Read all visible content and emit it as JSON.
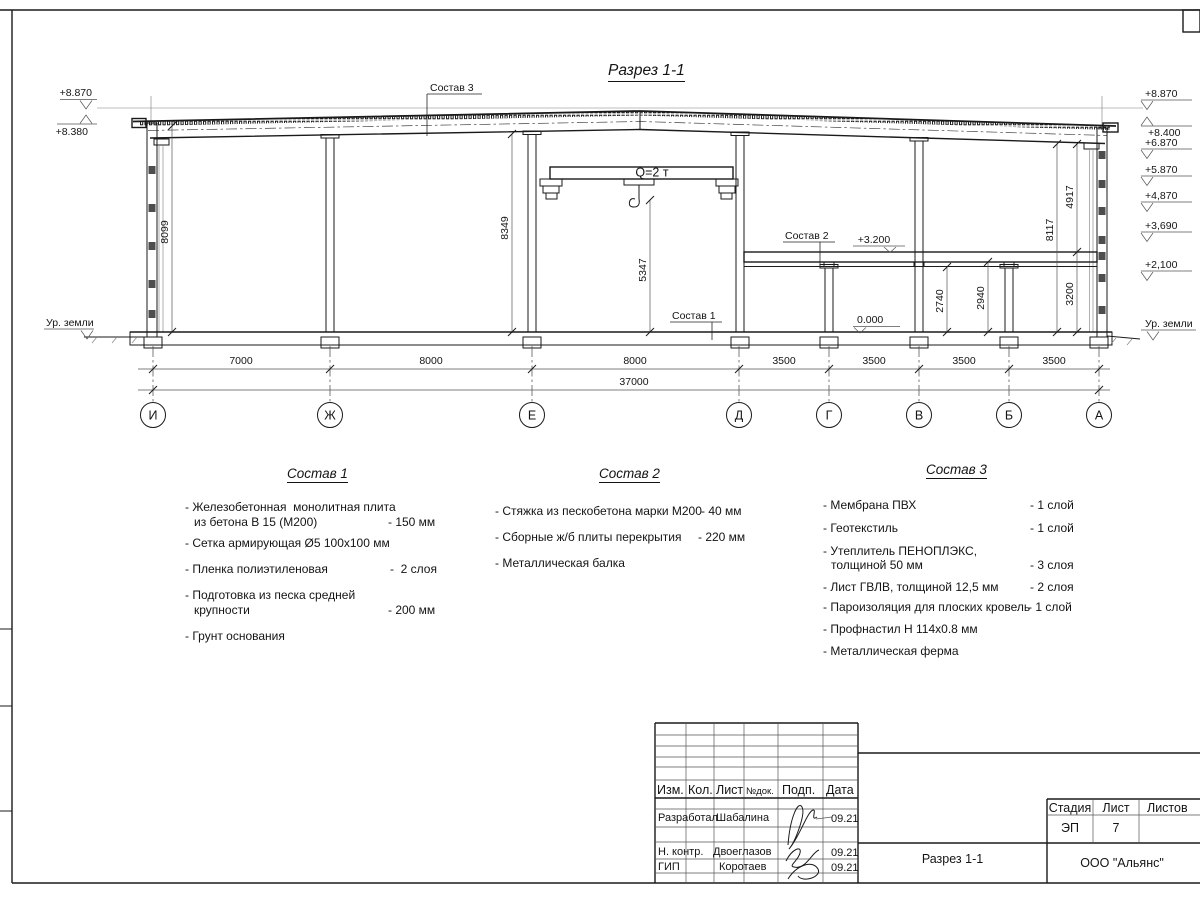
{
  "drawing": {
    "title": "Разрез 1-1",
    "crane_label": "Q=2 т",
    "leaders": {
      "s1": "Состав 1",
      "s2": "Состав 2",
      "s3": "Состав 3"
    },
    "elev_left": {
      "top": "+8.870",
      "eave": "+8.380",
      "ground": "Ур. земли"
    },
    "elev_right": [
      "+8.870",
      "+8.400",
      "+6.870",
      "+5.870",
      "+4,870",
      "+3,690",
      "+2,100"
    ],
    "elev_right_ground": "Ур. земли",
    "marks": {
      "mezz": "+3.200",
      "zero": "0.000"
    },
    "vdims": {
      "wall_left": "8099",
      "hall": "8349",
      "crane": "5347",
      "full_right": "8117",
      "upper_right": "4917",
      "mezz_h": "3200",
      "slab": "2940",
      "beam": "2740"
    },
    "hdims": [
      "7000",
      "8000",
      "8000",
      "3500",
      "3500",
      "3500",
      "3500"
    ],
    "total": "37000",
    "axes": [
      "И",
      "Ж",
      "Е",
      "Д",
      "Г",
      "В",
      "Б",
      "А"
    ]
  },
  "sostav1": {
    "title": "Состав 1",
    "items": [
      {
        "line1": "- Железобетонная  монолитная плита",
        "line2": "из бетона В 15 (М200)",
        "value": "- 150 мм"
      },
      {
        "line1": "- Сетка армирующая Ø5 100х100 мм",
        "line2": "",
        "value": ""
      },
      {
        "line1": "- Пленка полиэтиленовая",
        "line2": "",
        "value": "-  2 слоя"
      },
      {
        "line1": "- Подготовка из песка средней",
        "line2": "крупности",
        "value": "- 200 мм"
      },
      {
        "line1": "- Грунт основания",
        "line2": "",
        "value": ""
      }
    ]
  },
  "sostav2": {
    "title": "Состав 2",
    "items": [
      {
        "line1": "- Стяжка из пескобетона марки М200",
        "line2": "",
        "value": "- 40 мм"
      },
      {
        "line1": "- Сборные ж/б плиты перекрытия",
        "line2": "",
        "value": "- 220 мм"
      },
      {
        "line1": "- Металлическая балка",
        "line2": "",
        "value": ""
      }
    ]
  },
  "sostav3": {
    "title": "Состав 3",
    "items": [
      {
        "line1": "- Мембрана ПВХ",
        "line2": "",
        "value": "- 1 слой"
      },
      {
        "line1": "- Геотекстиль",
        "line2": "",
        "value": "- 1 слой"
      },
      {
        "line1": "- Утеплитель ПЕНОПЛЭКС,",
        "line2": "толщиной 50 мм",
        "value": "- 3 слоя"
      },
      {
        "line1": "- Лист ГВЛВ, толщиной 12,5 мм",
        "line2": "",
        "value": "- 2 слоя"
      },
      {
        "line1": "- Пароизоляция для плоских кровель",
        "line2": "",
        "value": "- 1 слой"
      },
      {
        "line1": "- Профнастил Н 114х0.8 мм",
        "line2": "",
        "value": ""
      },
      {
        "line1": "- Металлическая ферма",
        "line2": "",
        "value": ""
      }
    ]
  },
  "titleblock": {
    "cols": {
      "izm": "Изм.",
      "kol": "Кол.",
      "list": "Лист",
      "ndok": "№док.",
      "podp": "Подп.",
      "date": "Дата"
    },
    "rows": [
      {
        "role": "Разработал",
        "name": "Шабалина",
        "date": "09.21"
      },
      {
        "role": "Н. контр.",
        "name": "Двоеглазов",
        "date": "09.21"
      },
      {
        "role": "ГИП",
        "name": "Коротаев",
        "date": "09.21"
      }
    ],
    "stage": {
      "h_stadia": "Стадия",
      "h_list": "Лист",
      "h_listov": "Листов",
      "stadia": "ЭП",
      "list": "7"
    },
    "doc_title": "Разрез 1-1",
    "company": "ООО \"Альянс\""
  }
}
